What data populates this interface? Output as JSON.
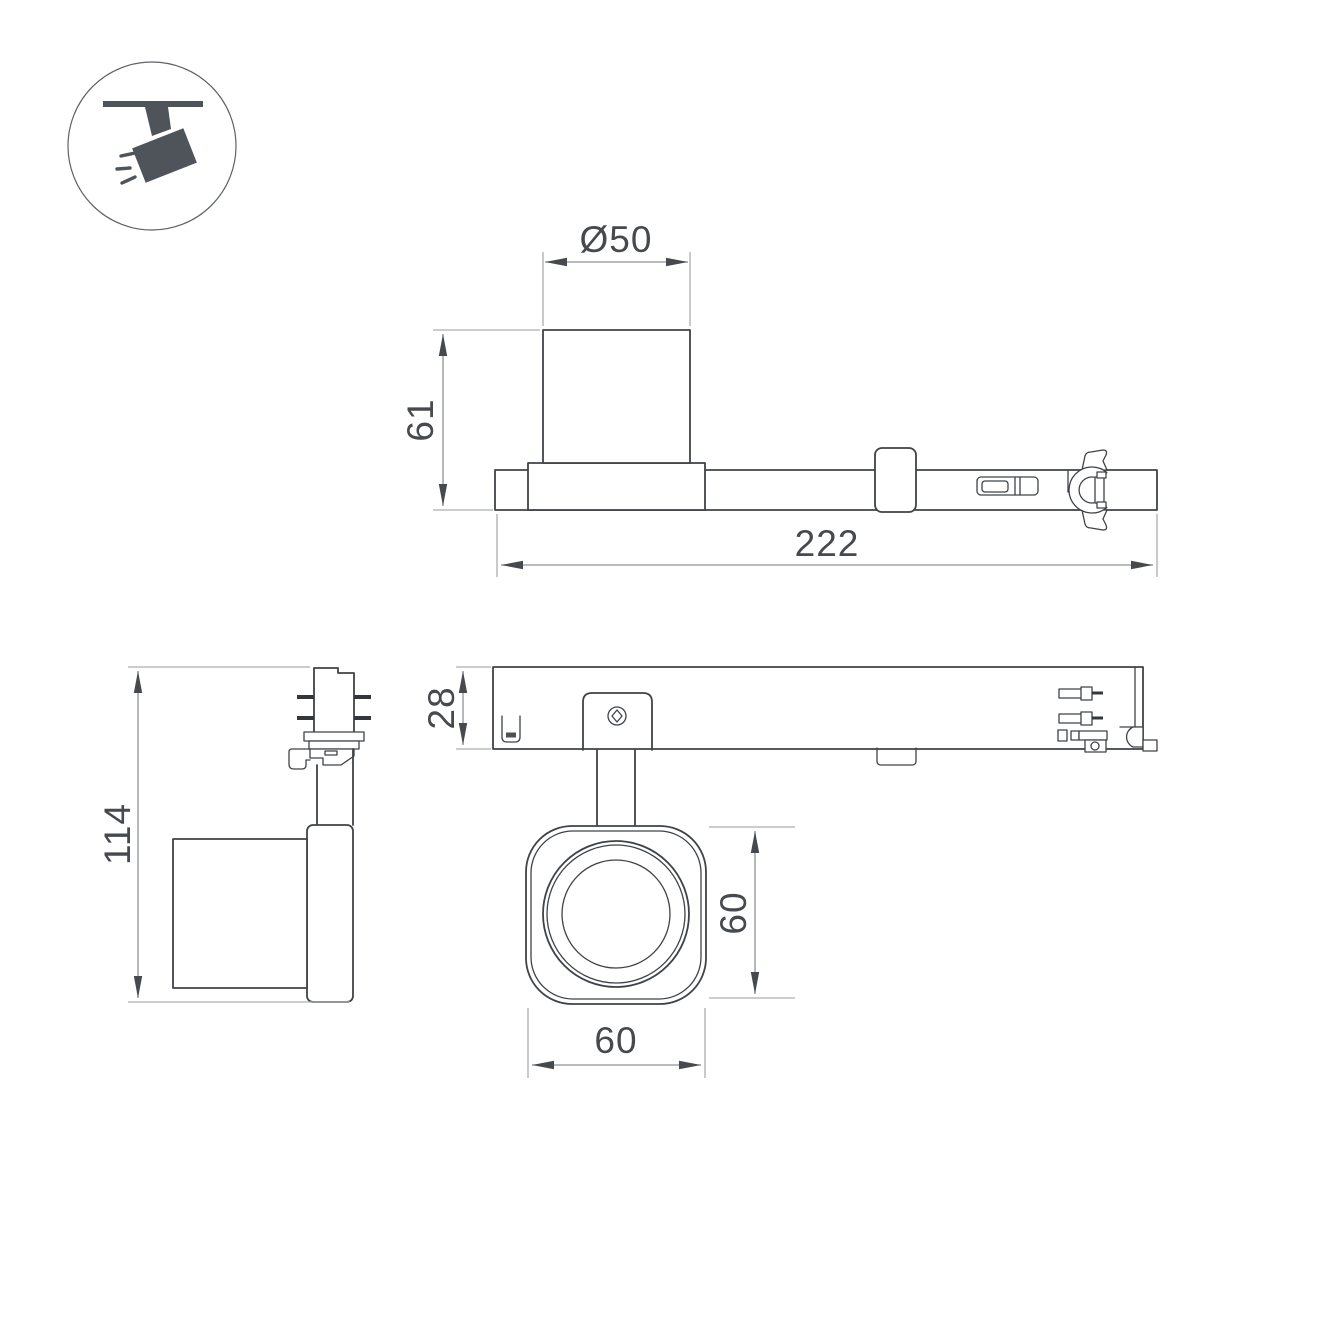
{
  "drawing": {
    "icon": {
      "name": "ceiling-track-spotlight-pictogram",
      "color": "#4e545a"
    },
    "colors": {
      "background": "#ffffff",
      "outline": "#3f4347",
      "dimension_line": "#8f9295",
      "extension_line": "#aaadb0",
      "text": "#46494d"
    },
    "dimensions": {
      "side_view": {
        "cylinder_diameter": "Ø50",
        "cylinder_height": "61",
        "total_length": "222"
      },
      "front_view": {
        "total_height": "114"
      },
      "top_view": {
        "track_depth": "28"
      },
      "lens_view": {
        "head_height": "60",
        "head_width": "60"
      }
    }
  }
}
